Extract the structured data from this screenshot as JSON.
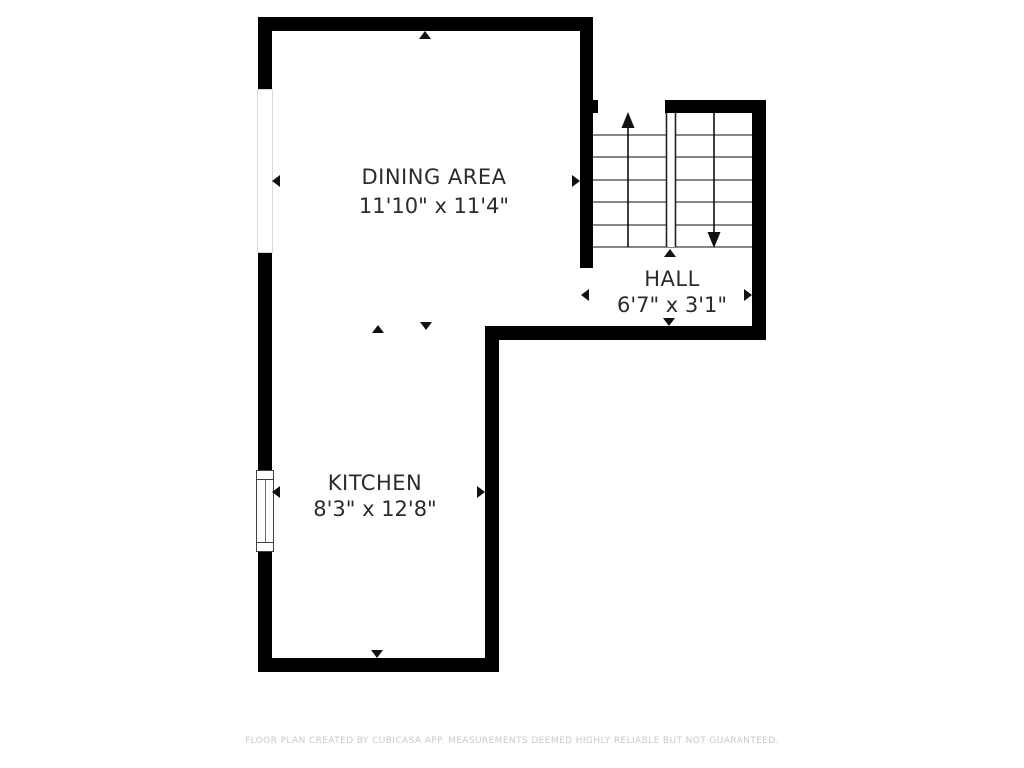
{
  "plan": {
    "type": "floor-plan",
    "rooms": [
      {
        "name": "DINING AREA",
        "dimensions": "11'10\" x 11'4\""
      },
      {
        "name": "HALL",
        "dimensions": "6'7\" x 3'1\""
      },
      {
        "name": "KITCHEN",
        "dimensions": "8'3\" x 12'8\""
      }
    ],
    "features": {
      "staircase": "u-shaped switchback with up arrow (left flight) and down arrow (right flight)",
      "windows": 2
    }
  },
  "palette": {
    "background": "#ffffff",
    "wall": "#000000",
    "room_text": "#2b2b2b",
    "stair_line": "#3f3f3f",
    "arrow": "#111111",
    "footer_text": "#c9c9c9"
  },
  "footer": {
    "disclaimer": "FLOOR PLAN CREATED BY CUBICASA APP. MEASUREMENTS DEEMED HIGHLY RELIABLE BUT NOT GUARANTEED."
  }
}
